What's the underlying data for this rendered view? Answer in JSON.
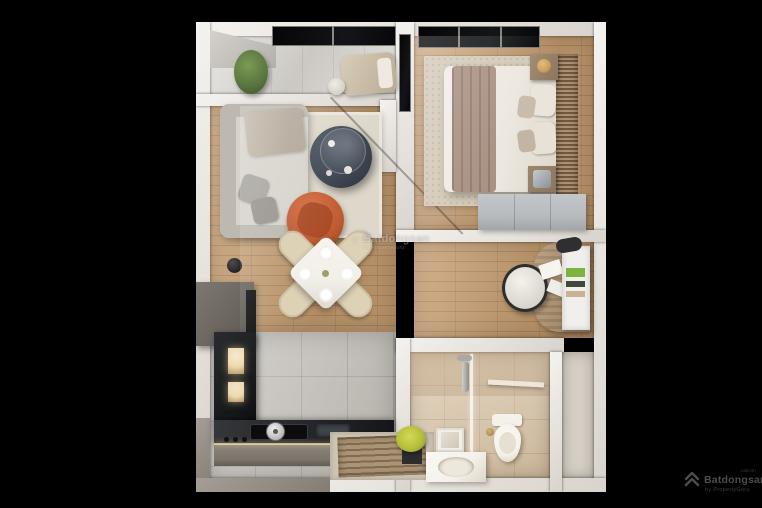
{
  "watermark": {
    "brand": "Batdongsan",
    "byline": "by PropertyGuru"
  },
  "logo": {
    "brand": "Batdongsan",
    "domain": ".com.vn",
    "byline": "by PropertyGuru"
  },
  "palette": {
    "bg": "#000000",
    "wall": "#ebe8e4",
    "woodFloor": "#c89f72",
    "balconyFloor": "#d8d5d0",
    "kitchenTile": "#c4c0b9",
    "bathTile": "#d8c5a9",
    "rightRoomFloor": "#d6cfc5",
    "rugLiving": "#ded8ca",
    "rugBedroom": "#d4cab8",
    "sofa": "#d7d3cc",
    "sofaShade": "#bdb9b1",
    "pillowGray": "#a8a5a0",
    "throwBlanket": "#b1a697",
    "coffeeTable": "#3a424e",
    "accentChair": "#c05a32",
    "diningTable": "#f2efe9",
    "diningChair": "#ddd1b6",
    "duvet": "#ece7df",
    "bedBlanket": "#a48a7b",
    "slatWood": "#8f7356",
    "wardrobe": "#b8bbbe",
    "nightstand": "#8d7660",
    "lampGold": "#c99e58",
    "deskWood": "#a5845e",
    "shelfWhite": "#f1efeb",
    "bookGreen": "#7cb23e",
    "counterTop": "#26272a",
    "counterFront": "#7b746b",
    "cabinetDark": "#1b1c1e",
    "cabinetGlow": "#ecd9ad",
    "matWood": "#a38a6a",
    "matFrame": "#cfc5b3",
    "plantGreen": "#58743e",
    "plantYellow": "#b5bf3a",
    "toiletWhite": "#f4f1ea"
  }
}
